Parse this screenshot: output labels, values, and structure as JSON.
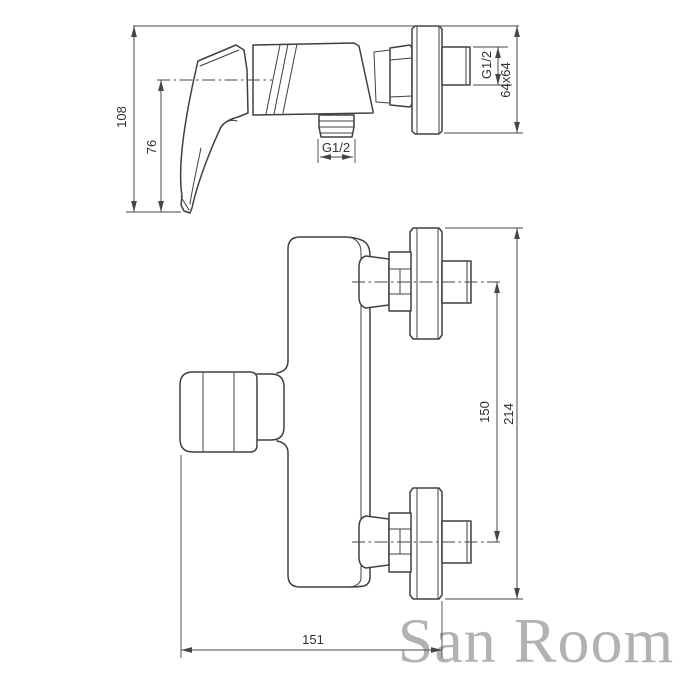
{
  "colors": {
    "background": "#ffffff",
    "line": "#3f4044",
    "dim_line": "#46464a",
    "text": "#313136",
    "watermark": "#b2b2b4"
  },
  "side_view": {
    "dim_overall_height": "108",
    "dim_handle_height": "76",
    "dim_outlet_thread": "G1/2",
    "dim_connector_thread": "G1/2",
    "dim_flange_size": "64x64"
  },
  "front_view": {
    "dim_connection_spacing": "150",
    "dim_overall_span": "214",
    "dim_overall_width": "151"
  },
  "watermark": {
    "text": "San Room"
  }
}
